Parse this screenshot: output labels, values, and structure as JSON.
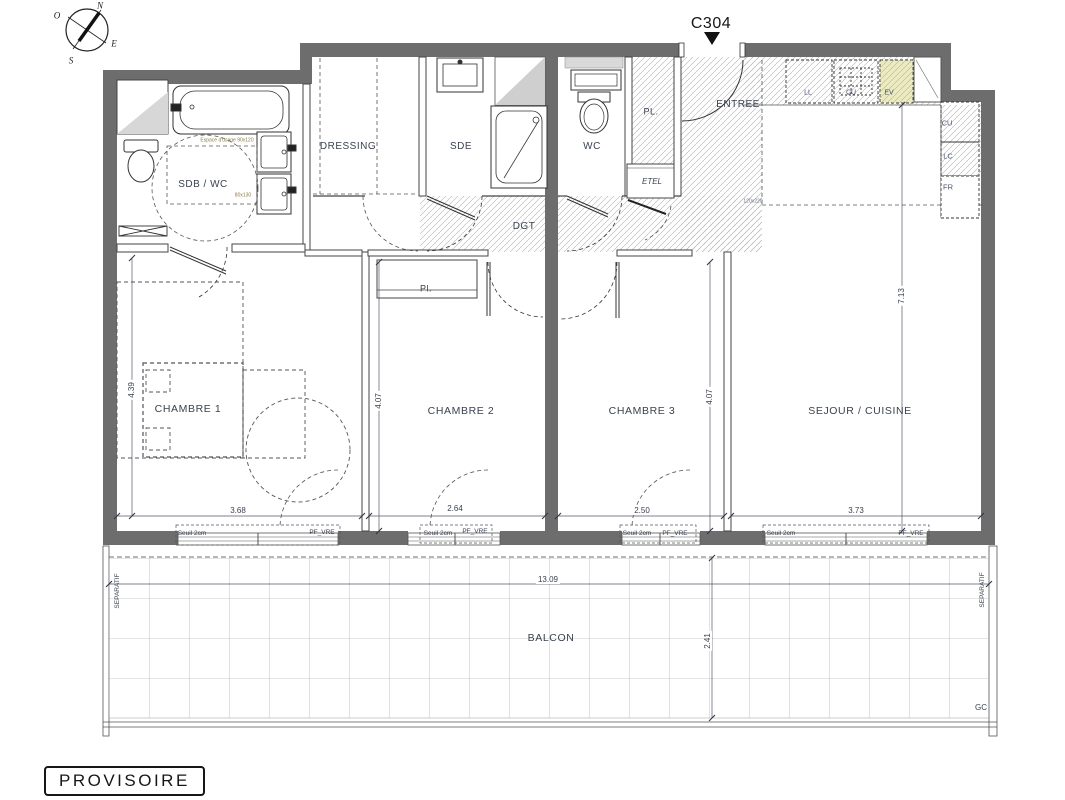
{
  "header": {
    "unit": "C304"
  },
  "stamp": {
    "label": "PROVISOIRE"
  },
  "compass": {
    "n": "N",
    "o": "O",
    "e": "E",
    "s": "S"
  },
  "rooms": {
    "sdb_wc": "SDB / WC",
    "dressing": "DRESSING",
    "sde": "SDE",
    "wc": "WC",
    "pl_entry": "PL.",
    "entree": "ENTREE",
    "etel": "ETEL",
    "dgt": "DGT",
    "pl_chambre2": "Pl.",
    "chambre1": "CHAMBRE 1",
    "chambre2": "CHAMBRE 2",
    "chambre3": "CHAMBRE 3",
    "sejour_cuisine": "SEJOUR / CUISINE",
    "balcon": "BALCON"
  },
  "kitchen_appliances": {
    "ll": "LL",
    "cu_hob": "CU",
    "ev": "EV",
    "cu": "CU",
    "lc": "LC",
    "fr": "FR"
  },
  "dimensions": {
    "chambre1_width": "3.68",
    "chambre1_depth": "4.39",
    "chambre2_width": "2.64",
    "chambre2_depth": "4.07",
    "chambre3_width": "2.50",
    "chambre3_depth": "4.07",
    "sejour_width": "3.73",
    "sejour_depth": "7.13",
    "balcon_width": "13.09",
    "balcon_depth": "2.41"
  },
  "windows": [
    {
      "seuil": "Seuil 2cm",
      "type": "PF_VRE"
    },
    {
      "seuil": "Seuil 2cm",
      "type": "PF_VRE"
    },
    {
      "seuil": "Seuil 2cm",
      "type": "PF_VRE"
    },
    {
      "seuil": "Seuil 2cm",
      "type": "PF_VRE"
    }
  ],
  "annotations": {
    "espace_usage": "Espace d'usage 90x120",
    "bed_zone": "80x130",
    "entry_zone": "120x220",
    "separatif_left": "SEPARATIF",
    "separatif_right": "SEPARATIF",
    "gc": "GC"
  }
}
